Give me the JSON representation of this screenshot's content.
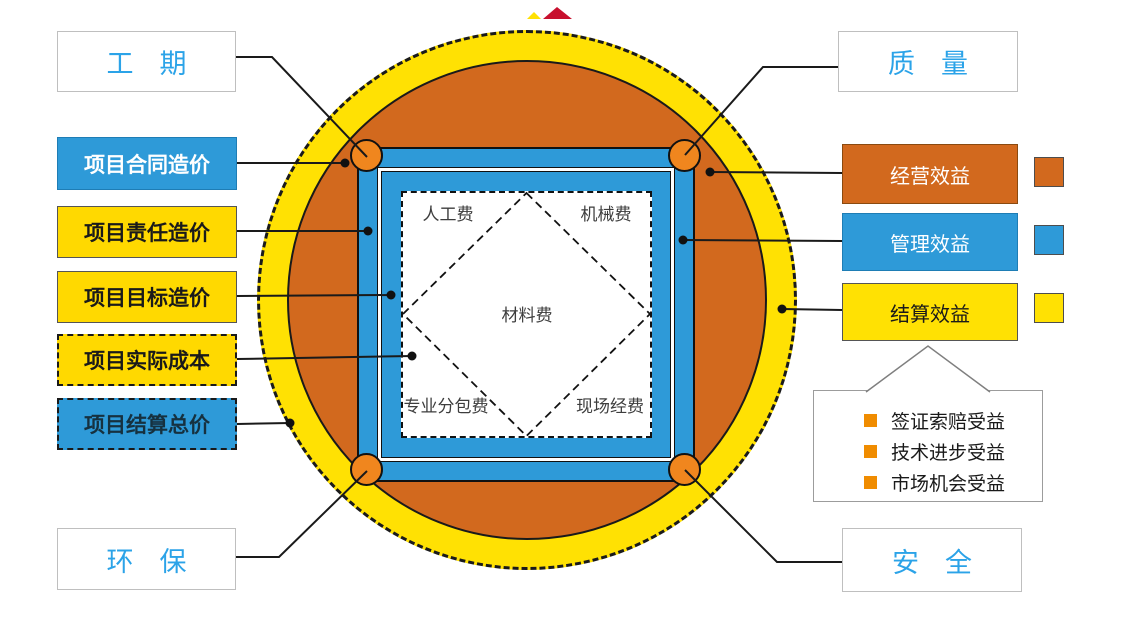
{
  "corner_labels": {
    "top_left": "工期",
    "top_right": "质量",
    "bottom_left": "环保",
    "bottom_right": "安全"
  },
  "left_boxes": [
    "项目合同造价",
    "项目责任造价",
    "项目目标造价",
    "项目实际成本",
    "项目结算总价"
  ],
  "right_boxes": [
    "经营效益",
    "管理效益",
    "结算效益"
  ],
  "callout_items": [
    "签证索赔受益",
    "技术进步受益",
    "市场机会受益"
  ],
  "cost_square": {
    "top_left": "人工费",
    "top_right": "机械费",
    "center": "材料费",
    "bottom_left": "专业分包费",
    "bottom_right": "现场经费"
  },
  "colors": {
    "ring_yellow": "#FFE103",
    "disc_orange": "#D2691E",
    "frame_blue": "#2E9AD8",
    "corner_circle_orange": "#F0861E",
    "accent_text_blue": "#2BA3E8",
    "bullet_orange": "#F08C00",
    "box_yellow": "#FFD900",
    "line_black": "#1A1A1A"
  }
}
